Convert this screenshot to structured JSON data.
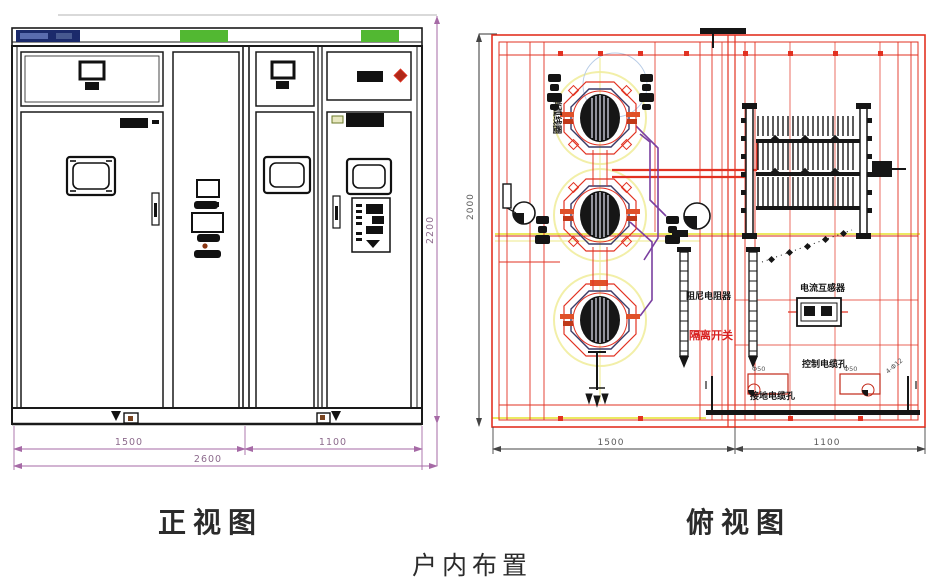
{
  "page": {
    "title": "户内布置"
  },
  "captions": {
    "front_view": "正视图",
    "top_view": "俯视图"
  },
  "front_view": {
    "dims": {
      "left_width": "1500",
      "right_width": "1100",
      "total_width": "2600",
      "height": "2200"
    }
  },
  "top_view": {
    "dims": {
      "left_width": "1500",
      "right_width": "1100",
      "depth": "2000"
    },
    "labels": {
      "coil": "消弧线圈",
      "damping_resistor": "阻尼电阻器",
      "disconnect_switch": "隔离开关",
      "current_transformer": "电流互感器",
      "control_cable_hole": "控制电缆孔",
      "ground_cable_hole": "接地电缆孔",
      "hole_note_left": "Φ50",
      "hole_note_right": "Φ50",
      "mounting_note": "4-Φ12"
    }
  },
  "colors": {
    "drawing_black": "#1a1a1a",
    "drawing_red": "#e23222",
    "dim_purple": "#a66aa6",
    "dim_gray": "#5a5a5a",
    "accent_green": "#52b832",
    "badge_navy": "#1b2a6b",
    "centerline_yellow": "#e6e22e",
    "cable_purple": "#7a3fa0"
  }
}
